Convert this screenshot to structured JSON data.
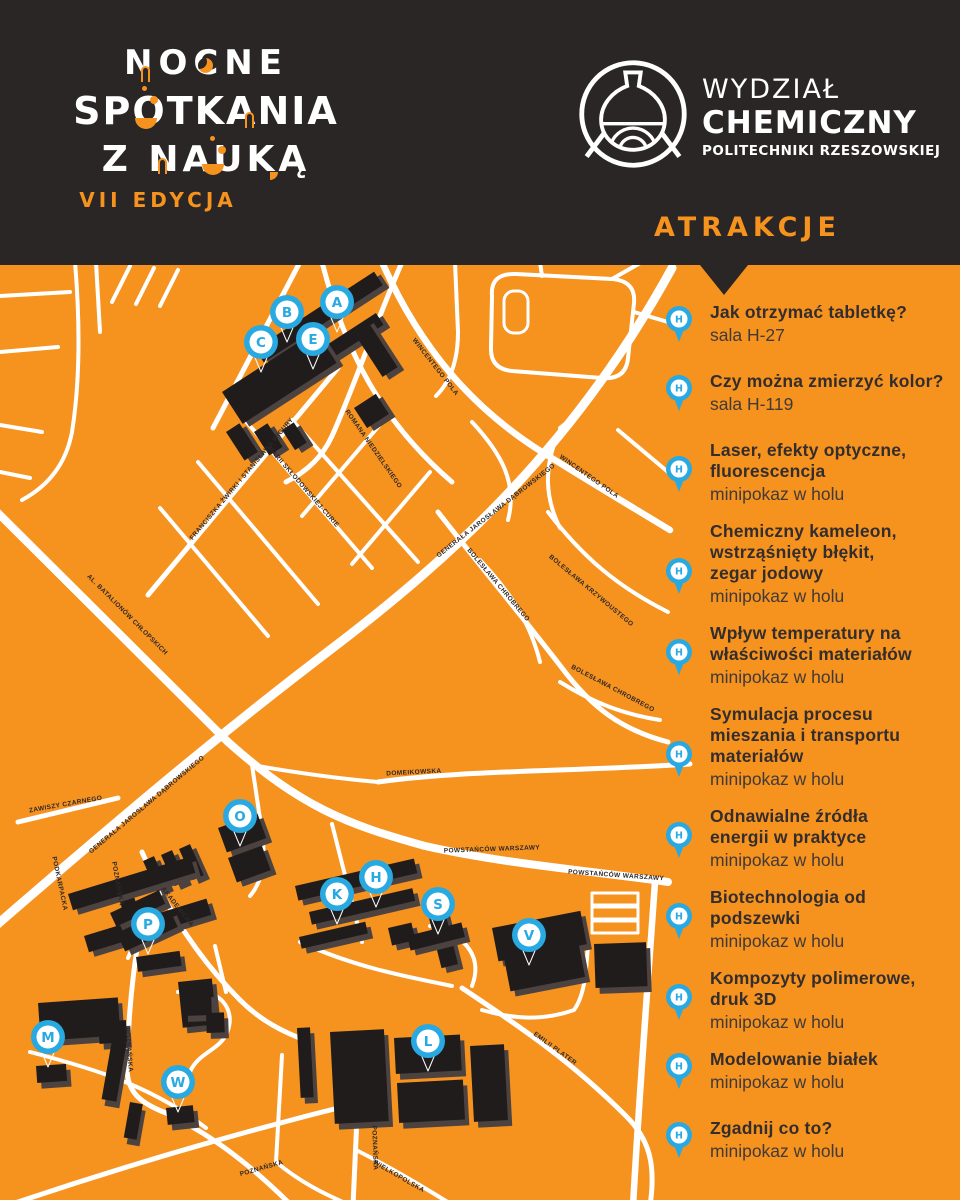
{
  "theme": {
    "orange": "#F6921E",
    "dark": "#2A2626",
    "blue": "#29A9E1",
    "building": "#201C1C",
    "road": "#FFFFFF"
  },
  "header": {
    "logo_line1": "NOCNE",
    "logo_line2": "SPOTKANIA",
    "logo_line3": "Z NAUKĄ",
    "edition": "VII EDYCJA",
    "faculty_line1": "WYDZIAŁ",
    "faculty_line2": "CHEMICZNY",
    "faculty_line3": "POLITECHNIKI RZESZOWSKIEJ",
    "attractions_heading": "ATRAKCJE"
  },
  "map": {
    "markers": [
      {
        "letter": "A",
        "x": 337,
        "y": 302
      },
      {
        "letter": "B",
        "x": 287,
        "y": 312
      },
      {
        "letter": "C",
        "x": 261,
        "y": 342
      },
      {
        "letter": "E",
        "x": 313,
        "y": 339
      },
      {
        "letter": "O",
        "x": 240,
        "y": 816
      },
      {
        "letter": "P",
        "x": 148,
        "y": 924
      },
      {
        "letter": "M",
        "x": 48,
        "y": 1037
      },
      {
        "letter": "W",
        "x": 178,
        "y": 1082
      },
      {
        "letter": "K",
        "x": 337,
        "y": 894
      },
      {
        "letter": "H",
        "x": 376,
        "y": 877
      },
      {
        "letter": "S",
        "x": 438,
        "y": 904
      },
      {
        "letter": "V",
        "x": 529,
        "y": 935
      },
      {
        "letter": "L",
        "x": 428,
        "y": 1041
      }
    ],
    "street_labels": [
      {
        "text": "WINCENTEGO POLA",
        "x": 434,
        "y": 368,
        "rot": 52
      },
      {
        "text": "WINCENTEGO POLA",
        "x": 588,
        "y": 478,
        "rot": 35
      },
      {
        "text": "ROMANA NIEDZIELSKIEGO",
        "x": 372,
        "y": 450,
        "rot": 55
      },
      {
        "text": "FRANCISZKA ŻWIRKI I STANISŁAWA WIGURY",
        "x": 243,
        "y": 480,
        "rot": -50
      },
      {
        "text": "MARII SKŁODOWSKIEJ-CURIE",
        "x": 302,
        "y": 488,
        "rot": 49
      },
      {
        "text": "GENERAŁA JAROSŁAWA DĄBROWSKIEGO",
        "x": 497,
        "y": 512,
        "rot": -38
      },
      {
        "text": "GENERAŁA JAROSŁAWA DĄBROWSKIEGO",
        "x": 148,
        "y": 806,
        "rot": -40
      },
      {
        "text": "AL. BATALIONÓW CHŁOPSKICH",
        "x": 126,
        "y": 616,
        "rot": 45
      },
      {
        "text": "ZAWISZY CZARNEGO",
        "x": 66,
        "y": 806,
        "rot": -10
      },
      {
        "text": "PODKARPACKA",
        "x": 58,
        "y": 884,
        "rot": 78
      },
      {
        "text": "POZNAŃSKA",
        "x": 116,
        "y": 884,
        "rot": 80
      },
      {
        "text": "POZNAŃSKA",
        "x": 127,
        "y": 1050,
        "rot": 85
      },
      {
        "text": "AKADEMICKA",
        "x": 176,
        "y": 908,
        "rot": 52
      },
      {
        "text": "POWSTAŃCÓW WARSZAWY",
        "x": 492,
        "y": 851,
        "rot": -2
      },
      {
        "text": "POWSTAŃCÓW WARSZAWY",
        "x": 616,
        "y": 877,
        "rot": 4
      },
      {
        "text": "DOMEIKOWSKA",
        "x": 414,
        "y": 774,
        "rot": -3
      },
      {
        "text": "BOLESŁAWA CHROBREGO",
        "x": 497,
        "y": 586,
        "rot": 50
      },
      {
        "text": "BOLESŁAWA KRZYWOUSTEGO",
        "x": 590,
        "y": 592,
        "rot": 40
      },
      {
        "text": "BOLESŁAWA CHROBREGO",
        "x": 612,
        "y": 690,
        "rot": 28
      },
      {
        "text": "EMILII PLATER",
        "x": 554,
        "y": 1050,
        "rot": 36
      },
      {
        "text": "POZNAŃSKA",
        "x": 262,
        "y": 1170,
        "rot": -16
      },
      {
        "text": "POZNAŃSKA",
        "x": 373,
        "y": 1148,
        "rot": 88
      },
      {
        "text": "WIELKOPOLSKA",
        "x": 398,
        "y": 1178,
        "rot": 30
      }
    ]
  },
  "attractions": [
    {
      "pin": "H",
      "title": "Jak otrzymać tabletkę?",
      "location": "sala H-27"
    },
    {
      "pin": "H",
      "title": "Czy można zmierzyć kolor?",
      "location": "sala H-119"
    },
    {
      "pin": "H",
      "title": "Laser, efekty optyczne,\nfluorescencja",
      "location": "minipokaz w holu"
    },
    {
      "pin": "H",
      "title": "Chemiczny kameleon,\nwstrząśnięty błękit,\nzegar jodowy",
      "location": "minipokaz w holu"
    },
    {
      "pin": "H",
      "title": "Wpływ temperatury na\nwłaściwości materiałów",
      "location": "minipokaz w holu"
    },
    {
      "pin": "H",
      "title": "Symulacja procesu\nmieszania i transportu\nmateriałów",
      "location": "minipokaz w holu"
    },
    {
      "pin": "H",
      "title": "Odnawialne źródła\nenergii w praktyce",
      "location": "minipokaz w holu"
    },
    {
      "pin": "H",
      "title": "Biotechnologia od\npodszewki",
      "location": "minipokaz w holu"
    },
    {
      "pin": "H",
      "title": "Kompozyty polimerowe,\ndruk 3D",
      "location": "minipokaz w holu"
    },
    {
      "pin": "H",
      "title": "Modelowanie białek",
      "location": "minipokaz w holu"
    },
    {
      "pin": "H",
      "title": "Zgadnij co to?",
      "location": "minipokaz w holu"
    }
  ]
}
